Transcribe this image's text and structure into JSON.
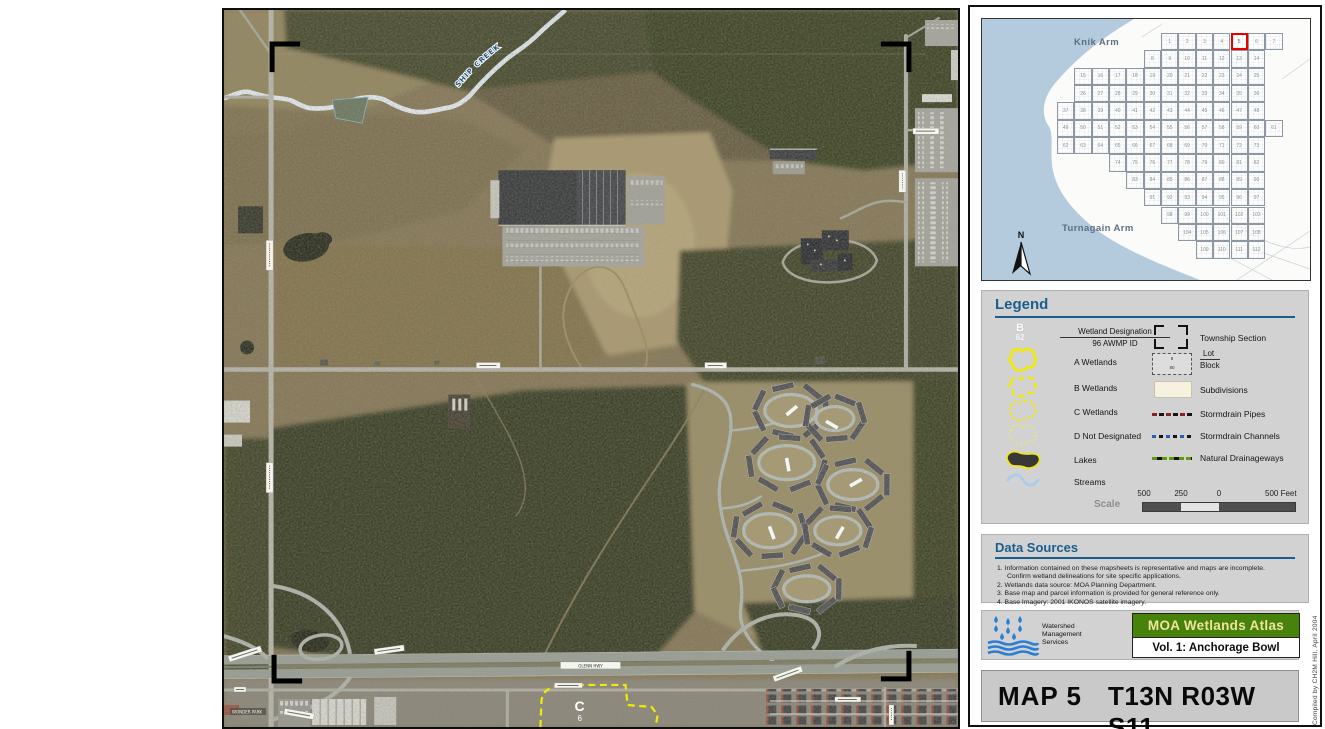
{
  "aerial": {
    "creek_label": "SHIP CREEK",
    "highway_label": "GLENN HWY",
    "park_label": "WONDER PARK",
    "wetland": {
      "letter": "C",
      "id": "6"
    }
  },
  "index_map": {
    "knik_label": "Knik Arm",
    "turnagain_label": "Turnagain Arm",
    "north_label": "N",
    "highlight_cell": 5,
    "rows": [
      {
        "start": 6,
        "first": 1,
        "count": 7
      },
      {
        "start": 5,
        "first": 8,
        "count": 7
      },
      {
        "start": 1,
        "first": 15,
        "count": 11
      },
      {
        "start": 1,
        "first": 26,
        "count": 11
      },
      {
        "start": 0,
        "first": 37,
        "count": 12
      },
      {
        "start": 0,
        "first": 49,
        "count": 13
      },
      {
        "start": 0,
        "first": 62,
        "count": 12
      },
      {
        "start": 3,
        "first": 74,
        "count": 9
      },
      {
        "start": 4,
        "first": 83,
        "count": 8
      },
      {
        "start": 5,
        "first": 91,
        "count": 7
      },
      {
        "start": 6,
        "first": 98,
        "count": 6
      },
      {
        "start": 7,
        "first": 104,
        "count": 5
      },
      {
        "start": 8,
        "first": 109,
        "count": 4
      }
    ]
  },
  "legend": {
    "title": "Legend",
    "designation": {
      "letter": "B",
      "id": "62",
      "line1": "Wetland Designation",
      "line2": "96 AWMP ID"
    },
    "left_items": [
      "A Wetlands",
      "B Wetlands",
      "C Wetlands",
      "D Not Designated",
      "Lakes",
      "Streams"
    ],
    "township_label": "Township Section",
    "lot_label": "Lot",
    "block_label": "Block",
    "lot_sample": "8",
    "block_sample": "80",
    "subdivisions_label": "Subdivisions",
    "stormdrain_pipes_label": "Stormdrain Pipes",
    "stormdrain_channels_label": "Stormdrain Channels",
    "drainageways_label": "Natural Drainageways",
    "scale_label": "Scale",
    "scale_ticks": [
      "500",
      "250",
      "0",
      "500 Feet"
    ]
  },
  "data_sources": {
    "title": "Data Sources",
    "lines": [
      "1. Information contained on these mapsheets is representative and maps are incomplete.",
      "Confirm wetland delineations for site specific applications.",
      "2. Wetlands data source: MOA Planning Department.",
      "3. Base map and parcel information is provided for general reference only.",
      "4. Base Imagery: 2001 IKONOS satellite imagery."
    ]
  },
  "title_block": {
    "org_line1": "Watershed",
    "org_line2": "Management",
    "org_line3": "Services",
    "atlas_title": "MOA Wetlands Atlas",
    "volume": "Vol. 1:  Anchorage Bowl",
    "credit": "Compiled by CH2M Hill, April 2004",
    "map_number": "MAP 5",
    "township": "T13N R03W S11"
  },
  "colors": {
    "heading_blue": "#1b5e8e",
    "panel_gray": "#d2d2d2",
    "atlas_green": "#47820a",
    "atlas_title_text": "#efe3a0",
    "wetland_yellow": "#f2ea00",
    "water_blue": "#b3cbdd",
    "highlight_red": "#e60000"
  }
}
